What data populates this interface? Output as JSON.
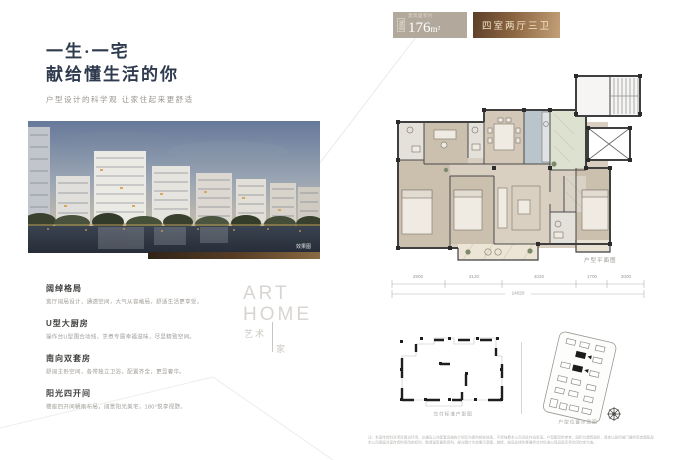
{
  "colors": {
    "ink": "#2e3a4d",
    "badge_grey": "#b2a89b",
    "bronze_dark": "#5d3f28",
    "bronze_light": "#c3a077",
    "badge_text": "#f3e3c9",
    "plan_wall": "#3f3f3f",
    "room_tan": "#cbbfae",
    "room_kitchen": "#b9c5cb",
    "room_entry": "#dde2d0"
  },
  "left": {
    "title_line1": "一生·一宅",
    "title_line2": "献给懂生活的你",
    "subtitle": "户型设计的科学观 让家住起来更舒适",
    "photo_caption": "效果图",
    "features": [
      {
        "heading": "阔绰格局",
        "desc": "宽厅阔局设计，通透空间，大气从容格局，舒适生活更享受。"
      },
      {
        "heading": "U型大厨房",
        "desc": "操作台U型围合动线，烹煮专属幸福滋味，尽显精致空间。"
      },
      {
        "heading": "南向双套房",
        "desc": "舒阔主卧空间，各带独立卫浴，配置齐全，更显奢华。"
      },
      {
        "heading": "阳光四开间",
        "desc": "楼座四开间朝南布局，阔景阳光美宅，180°悦享视野。"
      }
    ],
    "watermark": {
      "en1": "ART",
      "en2": "HOME",
      "cn1": "艺术",
      "cn2": "家"
    }
  },
  "header": {
    "area_side_label": "建面",
    "area_small_label": "建筑面积约",
    "area_value": "176",
    "area_unit": "m²",
    "layout_badge": "四室两厅三卫"
  },
  "floorplan": {
    "caption": "户型平面图",
    "dimensions": {
      "segments": [
        "2900",
        "3120",
        "4020",
        "1700",
        "2000"
      ],
      "total": "14020"
    }
  },
  "bottom_diagrams": {
    "left_caption": "交付标准户型图",
    "right_caption": "户型位置示意图"
  },
  "disclaimer": {
    "line1": "注：本宣传资料对项目周边环境、交通及公共配套设施的介绍仅为提供相关信息，不意味着本公司对此作出承诺。户型图仅供参考，面积为建筑面积，具体以政府部门最终审定图纸及商品房买卖合同约定为准。",
    "line2": "本公司保留对宣传资料修改的权利，敬请留意最新资料。部分图片为效果示意图，装修、部品及绿化等最终交付标准以商品房买卖合同约定为准。"
  }
}
